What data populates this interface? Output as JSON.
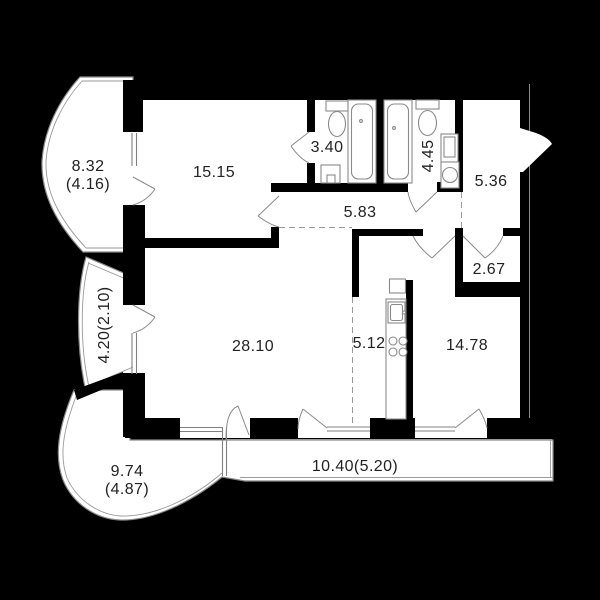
{
  "title": "apartment-floor-plan",
  "colors": {
    "background": "#000000",
    "walls": "#000000",
    "floor": "#ffffff",
    "linework": "#8a8a8a",
    "text": "#222222"
  },
  "rooms": {
    "balcony_top_left": {
      "area": "8.32",
      "area_reduced": "(4.16)"
    },
    "bedroom": {
      "area": "15.15"
    },
    "bathroom_small": {
      "area": "3.40"
    },
    "bathroom_large": {
      "area": "4.45"
    },
    "hallway": {
      "area": "5.36"
    },
    "corridor": {
      "area": "5.83"
    },
    "storage": {
      "area": "2.67"
    },
    "balcony_left": {
      "area": "4.20(2.10)"
    },
    "living_room": {
      "area": "28.10"
    },
    "kitchen": {
      "area": "5.12"
    },
    "room_second": {
      "area": "14.78"
    },
    "balcony_bottom_left": {
      "area": "9.74",
      "area_reduced": "(4.87)"
    },
    "balcony_bottom": {
      "area": "10.40(5.20)"
    }
  }
}
